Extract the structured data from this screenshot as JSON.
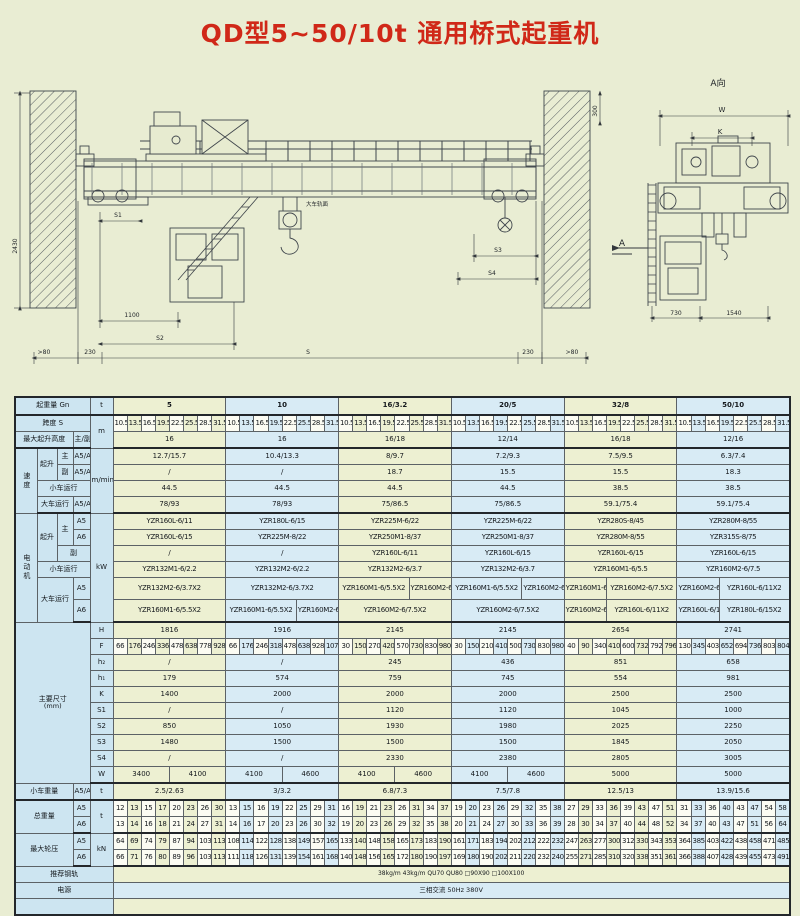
{
  "page": {
    "title": "QD型5~50/10t 通用桥式起重机"
  },
  "drawing": {
    "view_label": "A向",
    "direction_label": "A",
    "rail_surface_note": "大车轨面",
    "dims": {
      "w": "W",
      "k": "K",
      "s": "S",
      "s1": "S1",
      "s2": "S2",
      "s3": "S3",
      "s4": "S4",
      "d1100": "1100",
      "d230_left": "230",
      "d230_right": "230",
      "gt80_left": ">80",
      "gt80_right": ">80",
      "d2430": "2430",
      "d300": "300",
      "d730": "730",
      "d1540": "1540"
    }
  },
  "table": {
    "labels": {
      "capacity": "起重量 Gn",
      "span": "跨度 S",
      "lift_height": "最大起升高度",
      "main_aux": "主/副",
      "speed": "速度",
      "hoist": "起升",
      "main": "主",
      "aux": "副",
      "trolley_travel": "小车运行",
      "crane_travel": "大车运行",
      "motor": "电动机",
      "dims": "主要尺寸",
      "dims_unit": "(mm)",
      "trolley_weight": "小车重量",
      "total_weight": "总重量",
      "wheel_load": "最大轮压",
      "rail": "推荐钢轨",
      "power": "电源"
    },
    "units": {
      "t": "t",
      "m": "m",
      "m_min": "m/min",
      "kw": "kW",
      "kn": "kN",
      "a5": "A5",
      "a6": "A6",
      "a5a6": "A5/A6"
    },
    "capacities": [
      "5",
      "10",
      "16/3.2",
      "20/5",
      "32/8",
      "50/10"
    ],
    "spans": [
      "10.5",
      "13.5",
      "16.5",
      "19.5",
      "22.5",
      "25.5",
      "28.5",
      "31.5"
    ],
    "lift_height": [
      "16",
      "16",
      "16/18",
      "12/14",
      "16/18",
      "12/16"
    ],
    "speed": {
      "main": [
        "12.7/15.7",
        "10.4/13.3",
        "8/9.7",
        "7.2/9.3",
        "7.5/9.5",
        "6.3/7.4"
      ],
      "aux": [
        "/",
        "/",
        "18.7",
        "15.5",
        "15.5",
        "18.3"
      ],
      "trolley": [
        "44.5",
        "44.5",
        "44.5",
        "44.5",
        "38.5",
        "38.5"
      ],
      "crane": [
        "78/93",
        "78/93",
        "75/86.5",
        "75/86.5",
        "59.1/75.4",
        "59.1/75.4"
      ]
    },
    "motor": {
      "main_a5": [
        "YZR160L-6/11",
        "YZR180L-6/15",
        "YZR225M-6/22",
        "YZR225M-6/22",
        "YZR280S-8/45",
        "YZR280M-8/55"
      ],
      "main_a6": [
        "YZR160L-6/15",
        "YZR225M-8/22",
        "YZR250M1-8/37",
        "YZR250M1-8/37",
        "YZR280M-8/55",
        "YZR315S-8/75"
      ],
      "aux": [
        "/",
        "/",
        "YZR160L-6/11",
        "YZR160L-6/15",
        "YZR160L-6/15",
        "YZR160L-6/15"
      ],
      "trolley": [
        "YZR132M1-6/2.2",
        "YZR132M2-6/2.2",
        "YZR132M2-6/3.7",
        "YZR132M2-6/3.7",
        "YZR160M1-6/5.5",
        "YZR160M2-6/7.5"
      ],
      "crane_a5": [
        [
          "YZR132M2-6/3.7X2"
        ],
        [
          "YZR132M2-6/3.7X2"
        ],
        [
          "YZR160M1-6/5.5X2",
          "YZR160M2-6/7.5X2"
        ],
        [
          "YZR160M1-6/5.5X2",
          "YZR160M2-6/7.5X2"
        ],
        [
          "YZR160M1-6/5.5X2",
          "YZR160M2-6/7.5X2"
        ],
        [
          "YZR160M2-6/7.5X2",
          "YZR160L-6/11X2"
        ]
      ],
      "crane_a6": [
        [
          "YZR160M1-6/5.5X2"
        ],
        [
          "YZR160M1-6/5.5X2",
          "YZR160M2-6/7.5X2"
        ],
        [
          "YZR160M2-6/7.5X2"
        ],
        [
          "YZR160M2-6/7.5X2"
        ],
        [
          "YZR160M2-6/7.5X2",
          "YZR160L-6/11X2"
        ],
        [
          "YZR160L-6/11X2",
          "YZR180L-6/15X2"
        ]
      ]
    },
    "dim_symbols": {
      "H": "H",
      "F": "F",
      "h2": "h₂",
      "h1": "h₁",
      "K": "K",
      "S1": "S1",
      "S2": "S2",
      "S3": "S3",
      "S4": "S4",
      "W": "W"
    },
    "dims": {
      "H": [
        "1816",
        "1916",
        "2145",
        "2145",
        "2654",
        "2741"
      ],
      "F": [
        [
          66,
          176,
          246,
          336,
          478,
          638,
          778,
          928
        ],
        [
          66,
          176,
          246,
          318,
          478,
          638,
          928,
          1078
        ],
        [
          30,
          150,
          270,
          420,
          570,
          730,
          830,
          980
        ],
        [
          30,
          150,
          210,
          410,
          500,
          730,
          830,
          980
        ],
        [
          40,
          90,
          340,
          410,
          600,
          732,
          792,
          796
        ],
        [
          130,
          345,
          403,
          652,
          694,
          736,
          803,
          804
        ]
      ],
      "h2": [
        "/",
        "/",
        "245",
        "436",
        "851",
        "658"
      ],
      "h1": [
        "179",
        "574",
        "759",
        "745",
        "554",
        "981"
      ],
      "K": [
        "1400",
        "2000",
        "2000",
        "2000",
        "2500",
        "2500"
      ],
      "S1": [
        "/",
        "/",
        "1120",
        "1120",
        "1045",
        "1000"
      ],
      "S2": [
        "850",
        "1050",
        "1930",
        "1980",
        "2025",
        "2250"
      ],
      "S3": [
        "1480",
        "1500",
        "1500",
        "1500",
        "1845",
        "2050"
      ],
      "S4": [
        "/",
        "/",
        "2330",
        "2380",
        "2805",
        "3005"
      ],
      "W": [
        [
          "3400",
          "4100"
        ],
        [
          "4100",
          "4600"
        ],
        [
          "4100",
          "4600"
        ],
        [
          "4100",
          "4600"
        ],
        [
          "5000"
        ],
        [
          "5000"
        ]
      ]
    },
    "trolley_weight": [
      "2.5/2.63",
      "3/3.2",
      "6.8/7.3",
      "7.5/7.8",
      "12.5/13",
      "13.9/15.6"
    ],
    "total_weight": {
      "a5": [
        [
          12,
          13,
          15,
          17,
          20,
          23,
          26,
          30
        ],
        [
          13,
          15,
          16,
          19,
          22,
          25,
          29,
          31
        ],
        [
          16,
          19,
          21,
          23,
          26,
          31,
          34,
          37
        ],
        [
          19,
          20,
          23,
          26,
          29,
          32,
          35,
          38
        ],
        [
          27,
          29,
          33,
          36,
          39,
          43,
          47,
          51
        ],
        [
          31,
          33,
          36,
          40,
          43,
          47,
          54,
          58
        ]
      ],
      "a6": [
        [
          13,
          14,
          16,
          18,
          21,
          24,
          27,
          31
        ],
        [
          14,
          16,
          17,
          20,
          23,
          26,
          30,
          32
        ],
        [
          19,
          20,
          23,
          26,
          29,
          32,
          35,
          38
        ],
        [
          20,
          21,
          24,
          27,
          30,
          33,
          36,
          39
        ],
        [
          28,
          30,
          34,
          37,
          40,
          44,
          48,
          52
        ],
        [
          34,
          37,
          40,
          43,
          47,
          51,
          56,
          64
        ]
      ]
    },
    "wheel_load": {
      "a5": [
        [
          64,
          69,
          74,
          79,
          87,
          94,
          103,
          113
        ],
        [
          108,
          114,
          122,
          128,
          138,
          149,
          157,
          165
        ],
        [
          133,
          140,
          148,
          158,
          165,
          173,
          183,
          190
        ],
        [
          161,
          171,
          183,
          194,
          202,
          212,
          222,
          232
        ],
        [
          247,
          263,
          277,
          300,
          312,
          330,
          343,
          353
        ],
        [
          364,
          385,
          403,
          422,
          438,
          458,
          471,
          485
        ]
      ],
      "a6": [
        [
          66,
          71,
          76,
          80,
          89,
          96,
          103,
          113
        ],
        [
          111,
          118,
          126,
          131,
          139,
          154,
          161,
          168
        ],
        [
          140,
          148,
          156,
          165,
          172,
          180,
          190,
          197
        ],
        [
          169,
          180,
          190,
          202,
          211,
          220,
          232,
          240
        ],
        [
          255,
          271,
          285,
          310,
          320,
          338,
          351,
          361
        ],
        [
          366,
          388,
          407,
          428,
          439,
          455,
          473,
          491
        ]
      ]
    },
    "rail": "38kg/m  43kg/m  QU70  QU80  □90X90  □100X100",
    "power": "三相交流  50Hz  380V"
  }
}
